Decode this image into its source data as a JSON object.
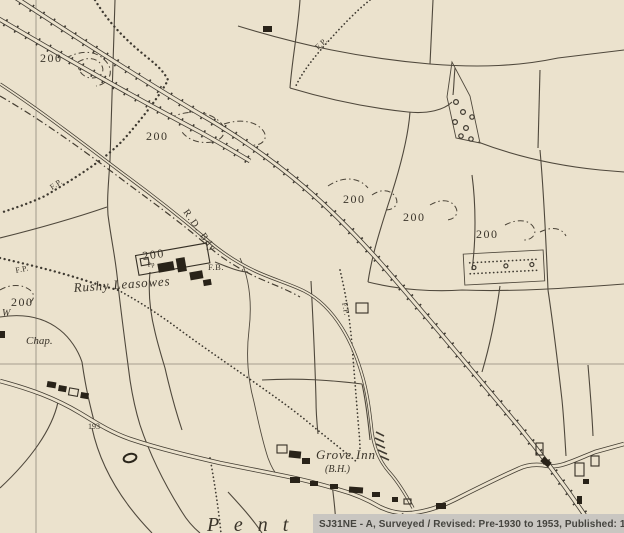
{
  "window": {
    "width": 624,
    "height": 533
  },
  "colors": {
    "paper": "#ebe2cd",
    "ink": "#3f3a31",
    "building": "#292319",
    "grid_line": "#90887a",
    "caption_bar": "#c9c6c1",
    "caption_text": "#45443f"
  },
  "map": {
    "type": "historic-ordnance-survey-map",
    "contour_labels": [
      {
        "text": "200",
        "x": 40,
        "y": 62
      },
      {
        "text": "200",
        "x": 146,
        "y": 140
      },
      {
        "text": "200",
        "x": 11,
        "y": 306
      },
      {
        "text": "200",
        "x": 143,
        "y": 260
      },
      {
        "text": "200",
        "x": 343,
        "y": 203
      },
      {
        "text": "200",
        "x": 403,
        "y": 221
      },
      {
        "text": "200",
        "x": 476,
        "y": 238
      }
    ],
    "labels": [
      {
        "id": "fp-1",
        "text": "F.P."
      },
      {
        "id": "fp-2",
        "text": "F.P."
      },
      {
        "id": "fp-3",
        "text": "F.P."
      },
      {
        "id": "fp-4",
        "text": "F.P."
      },
      {
        "id": "footbridge",
        "text": "F.B."
      },
      {
        "id": "rd-boundary",
        "text": "R.D. Bdy"
      },
      {
        "id": "farm-name",
        "text": "Rushy Leasowes"
      },
      {
        "id": "pump",
        "text": "Pp"
      },
      {
        "id": "well",
        "text": "W"
      },
      {
        "id": "chapel",
        "text": "Chap."
      },
      {
        "id": "inn-name",
        "text": "Grove Inn"
      },
      {
        "id": "inn-type",
        "text": "(B.H.)"
      },
      {
        "id": "spot-height",
        "text": "193"
      },
      {
        "id": "place-name",
        "text": "P e n t"
      }
    ]
  },
  "caption": {
    "text": "SJ31NE - A, Surveyed / Revised: Pre-1930 to 1953, Published: 1954"
  }
}
